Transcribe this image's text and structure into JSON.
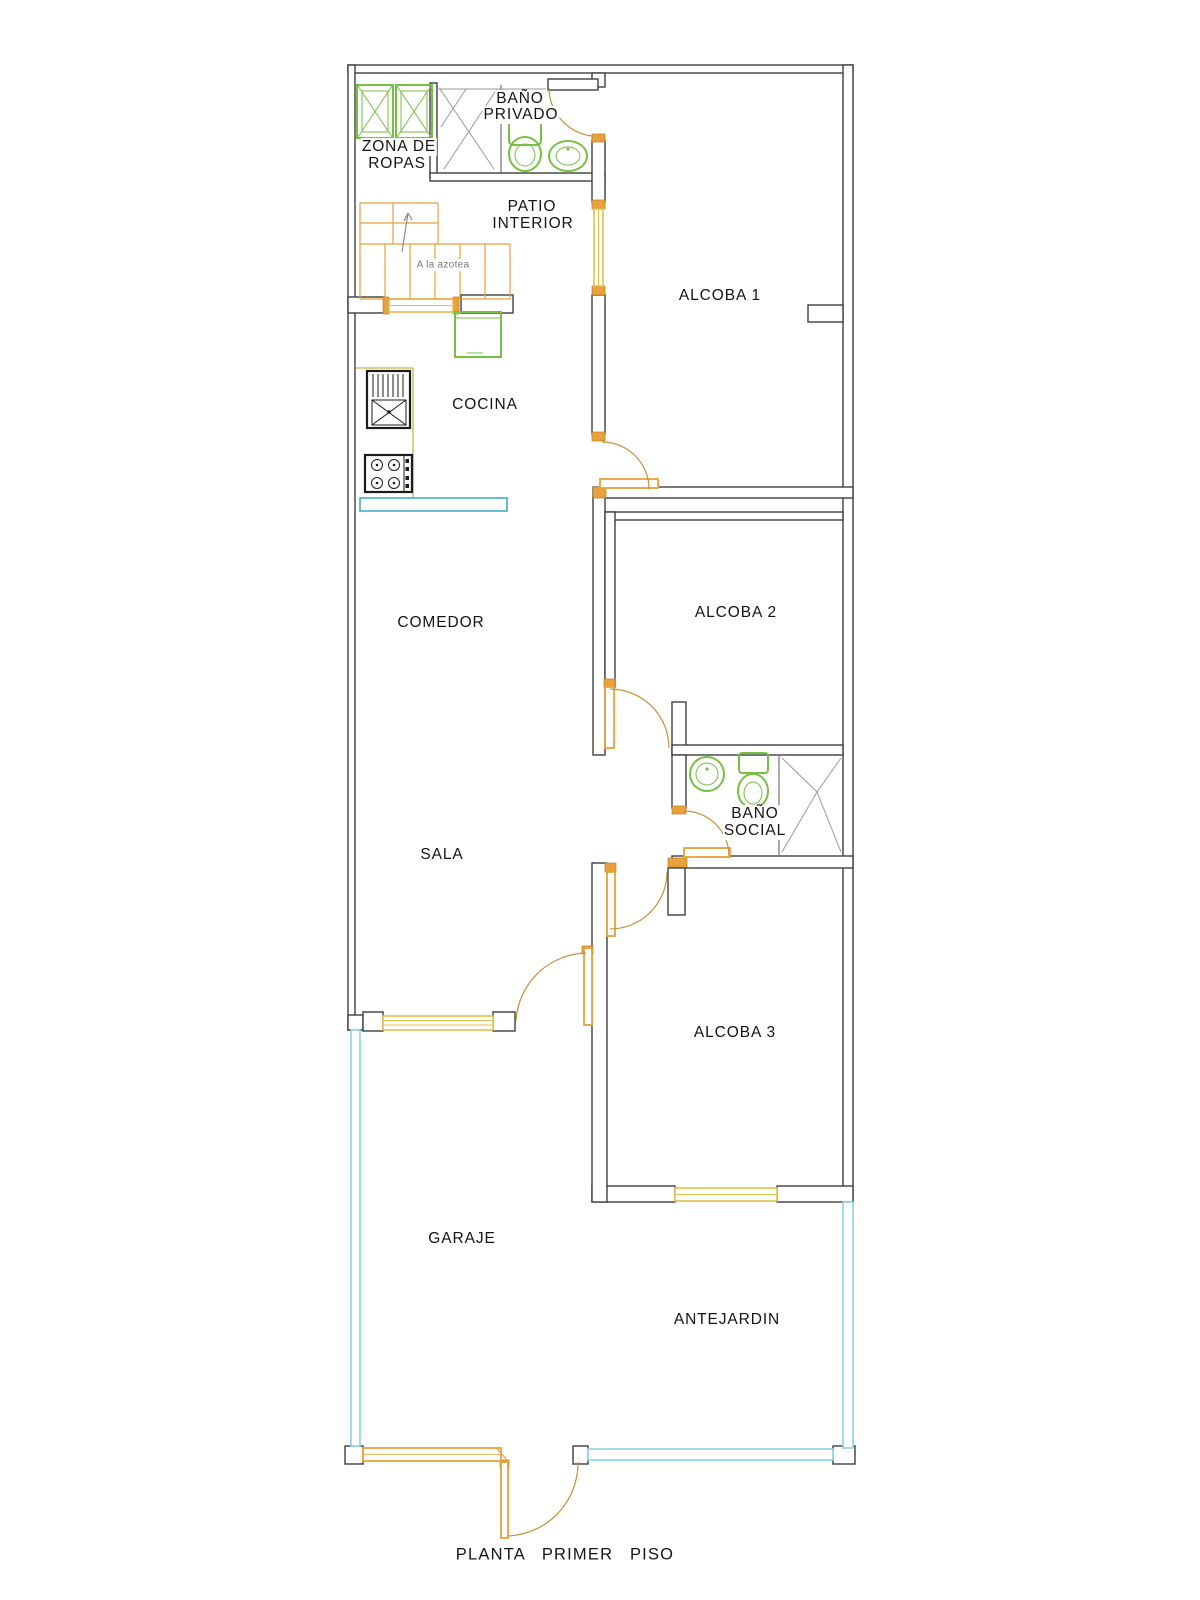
{
  "drawing": {
    "title": "PLANTA PRIMER PISO",
    "rooms": {
      "zona_de_ropas": {
        "line1": "ZONA DE",
        "line2": "ROPAS"
      },
      "bano_privado": {
        "line1": "BAÑO",
        "line2": "PRIVADO"
      },
      "patio_interior": {
        "line1": "PATIO",
        "line2": "INTERIOR"
      },
      "alcoba_1": {
        "label": "ALCOBA 1"
      },
      "cocina": {
        "label": "COCINA"
      },
      "comedor": {
        "label": "COMEDOR"
      },
      "alcoba_2": {
        "label": "ALCOBA 2"
      },
      "bano_social": {
        "line1": "BAÑO",
        "line2": "SOCIAL"
      },
      "sala": {
        "label": "SALA"
      },
      "alcoba_3": {
        "label": "ALCOBA 3"
      },
      "garaje": {
        "label": "GARAJE"
      },
      "antejardin": {
        "label": "ANTEJARDIN"
      }
    },
    "annotations": {
      "stairs_note": "A la azotea"
    },
    "colors": {
      "walls": "#3f3f3f",
      "door_wood": "#E8A13C",
      "door_arc": "#C98F3D",
      "window_glass": "#E3BE4A",
      "fixture_green": "#76C043",
      "boundary_cyan": "#8AD4E4",
      "counter_teal": "#3FAFC4",
      "detail_gray": "#9A9A9A"
    }
  }
}
